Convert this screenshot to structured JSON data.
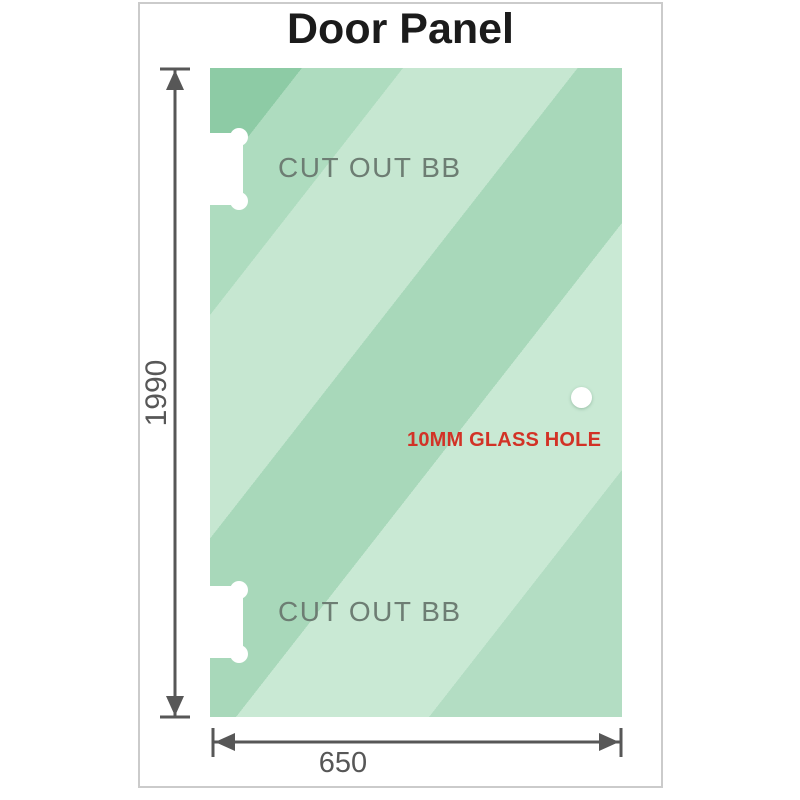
{
  "title": "Door Panel",
  "glass_panel": {
    "cutouts": [
      {
        "label": "CUT OUT BB",
        "position": "top-left"
      },
      {
        "label": "CUT OUT BB",
        "position": "bottom-left"
      }
    ],
    "hole": {
      "label": "10MM GLASS HOLE"
    }
  },
  "dimensions": {
    "height": {
      "value": "1990"
    },
    "width": {
      "value": "650"
    }
  },
  "colors": {
    "title_color": "#1b1b1b",
    "dimension_color": "#575757",
    "cutout_label_color": "#6d7d73",
    "hole_label_color": "#d23226",
    "card_border_color": "#cbcbcb",
    "cutout_fill": "#ffffff",
    "glass_band_1": "#8dcba5",
    "glass_band_2": "#aedcbf",
    "glass_band_3": "#c6e7d1",
    "glass_band_4": "#a8d8ba",
    "glass_band_5": "#c9e9d4",
    "glass_band_6": "#b3ddc3"
  }
}
